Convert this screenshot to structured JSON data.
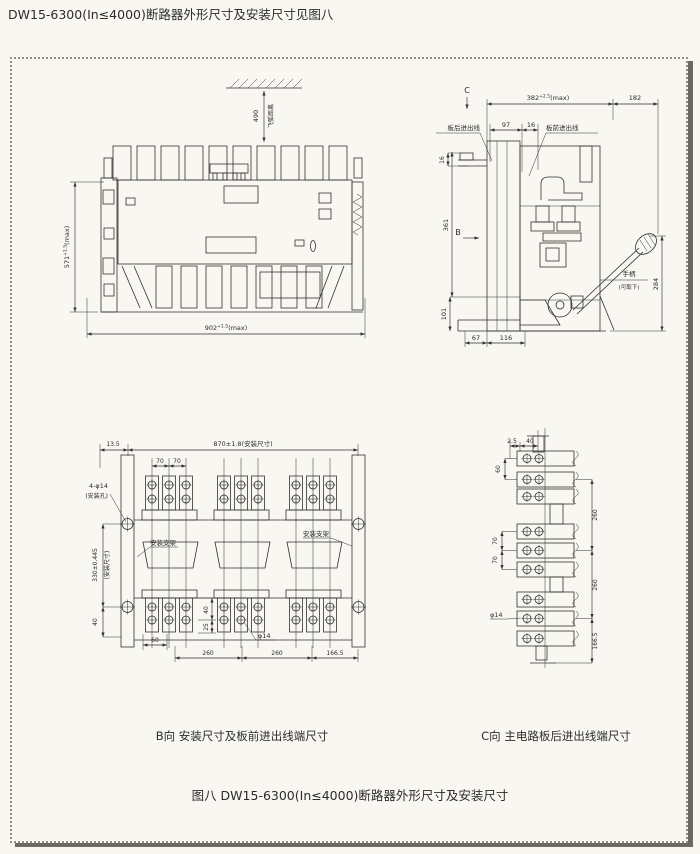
{
  "page": {
    "title": "DW15-6300(In≤4000)断路器外形尺寸及安装尺寸见图八",
    "figure_caption": "图八 DW15-6300(In≤4000)断路器外形尺寸及安装尺寸",
    "paper_color": "#f8f7f2",
    "ink_color": "#33312c",
    "frame_border_color": "#8f8d85",
    "frame_shadow_color": "#6b6960"
  },
  "front_view": {
    "arc_gap_dim": "490",
    "arc_gap_label": "飞弧距离",
    "height_dim": {
      "base": "571",
      "tol": "+1.5",
      "suffix": "(max)"
    },
    "width_dim": {
      "base": "902",
      "tol": "+1.5",
      "suffix": "(max)"
    }
  },
  "side_view": {
    "view_c_marker": "C",
    "depth_dim": {
      "base": "382",
      "tol": "+2.5",
      "suffix": "(max)"
    },
    "dim_182": "182",
    "dim_97": "97",
    "dim_16_top": "16",
    "rear_wiring_label": "板后进出线",
    "front_wiring_label": "板前进出线",
    "dim_16_left": "16",
    "dim_361": "361",
    "view_b_marker": "B",
    "dim_101": "101",
    "dim_67": "67",
    "dim_116": "116",
    "dim_284": "284",
    "handle_label": "手柄",
    "handle_note": "(可取下)"
  },
  "b_view": {
    "caption": "B向 安装尺寸及板前进出线端尺寸",
    "dim_13_5": "13.5",
    "mount_width_dim": "870±1.8(安装尺寸)",
    "dim_70_a": "70",
    "dim_70_b": "70",
    "mount_holes_label": "4-φ14",
    "mount_holes_note": "(安装孔)",
    "bracket_label_left": "安装支架",
    "bracket_label_right": "安装支架",
    "mount_height_dim": "330±0.445",
    "mount_height_note": "(安装尺寸)",
    "dim_40_left": "40",
    "dim_60": "60",
    "dim_40_hole": "40",
    "dim_25": "25",
    "hole_dia_label": "φ14",
    "dim_260_a": "260",
    "dim_260_b": "260",
    "dim_166_5": "166.5"
  },
  "c_view": {
    "caption": "C向 主电路板后进出线端尺寸",
    "dim_2_5": "2.5",
    "dim_40": "40",
    "dim_60": "60",
    "dim_260_a": "260",
    "dim_70_a": "70",
    "dim_70_b": "70",
    "dim_260_b": "260",
    "hole_dia_label": "φ14",
    "dim_166_5": "166.5"
  }
}
